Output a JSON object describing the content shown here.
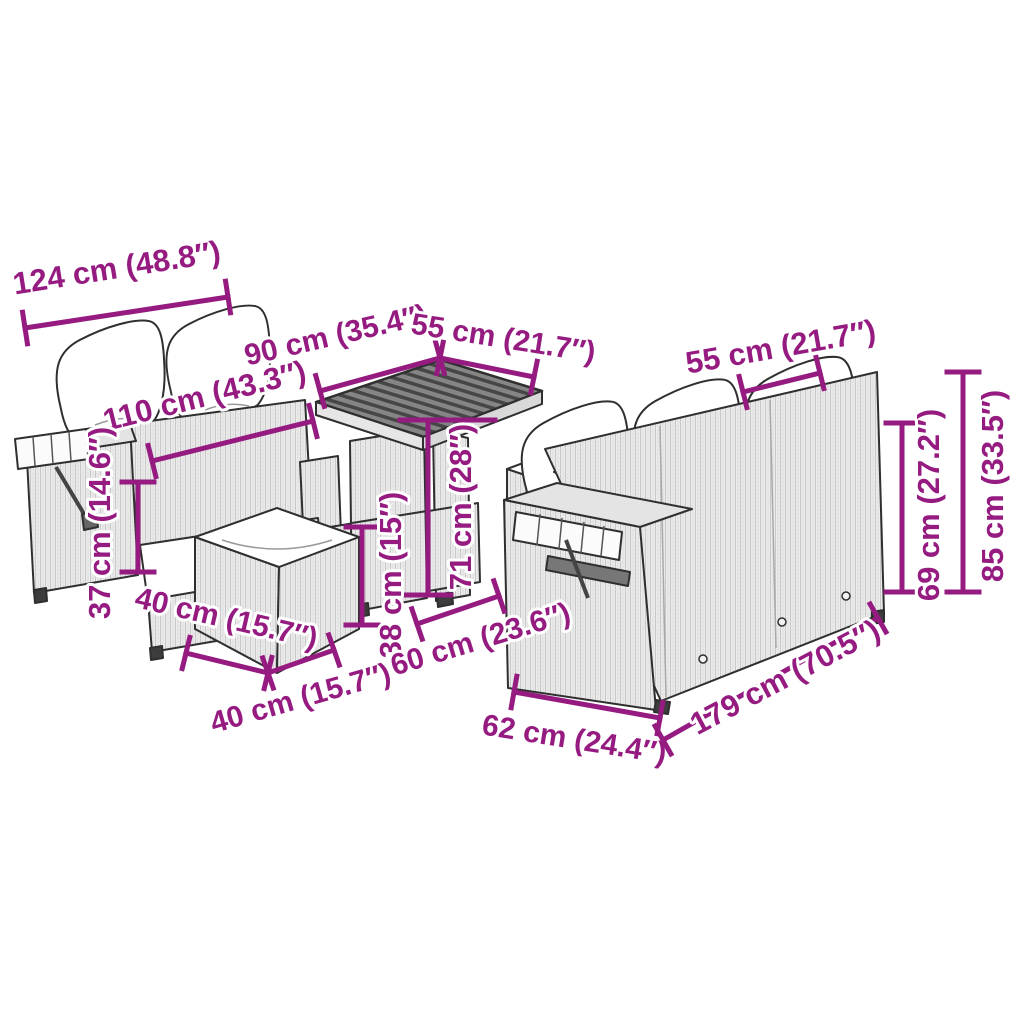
{
  "page": {
    "width": 1024,
    "height": 1024,
    "background": "#ffffff"
  },
  "diagram": {
    "description": "Poly rattan garden furniture set dimension diagram",
    "accent_color": "#951b81",
    "outline_color": "#2f2f2f",
    "pieces": [
      {
        "name": "two-seater-sofa-with-folding-tray"
      },
      {
        "name": "pedestal-table"
      },
      {
        "name": "footstool-front"
      },
      {
        "name": "footstool-middle"
      },
      {
        "name": "three-seater-sofa-with-folding-tray"
      }
    ],
    "dimensions": [
      {
        "name": "sofa2-width",
        "label": "124 cm (48.8″)",
        "line": [
          25,
          328,
          228,
          297
        ],
        "text": [
          117,
          270,
          -9,
          31
        ]
      },
      {
        "name": "sofa2-seat-width",
        "label": "110 cm (43.3″)",
        "line": [
          152,
          461,
          313,
          421
        ],
        "text": [
          205,
          398,
          -14,
          31
        ]
      },
      {
        "name": "table-length",
        "label": "90 cm (35.4″)",
        "line": [
          320,
          391,
          440,
          358
        ],
        "text": [
          336,
          337,
          -13,
          30
        ]
      },
      {
        "name": "table-width",
        "label": "55 cm (21.7″)",
        "line": [
          440,
          358,
          534,
          377
        ],
        "text": [
          503,
          340,
          9,
          30
        ]
      },
      {
        "name": "sofa3-cushion-width",
        "label": "55 cm (21.7″)",
        "line": [
          743,
          392,
          820,
          373
        ],
        "text": [
          781,
          349,
          -10,
          31
        ]
      },
      {
        "name": "table-height",
        "label": "71 cm (28″)",
        "line": [
          428,
          420,
          428,
          595
        ],
        "ticks": [
          [
            400,
            420,
            495,
            420
          ],
          [
            405,
            595,
            451,
            595
          ]
        ],
        "text": [
          463,
          507,
          -90,
          31
        ]
      },
      {
        "name": "table-shelf-height",
        "label": "38 cm (15″)",
        "line": [
          362,
          527,
          362,
          625
        ],
        "text": [
          393,
          575,
          -90,
          31
        ]
      },
      {
        "name": "sofa2-seat-height",
        "label": "37 cm (14.6″)",
        "line": [
          138,
          482,
          138,
          572
        ],
        "text": [
          102,
          523,
          -90,
          31
        ]
      },
      {
        "name": "stool-width",
        "label": "40 cm (15.7″)",
        "line": [
          186,
          653,
          268,
          673
        ],
        "text": [
          226,
          620,
          13,
          30
        ]
      },
      {
        "name": "stool-depth",
        "label": "40 cm (15.7″)",
        "line": [
          268,
          673,
          334,
          650
        ],
        "text": [
          301,
          700,
          -16,
          30
        ]
      },
      {
        "name": "sofa3-seat-depth",
        "label": "60 cm (23.6″)",
        "line": [
          417,
          624,
          499,
          596
        ],
        "text": [
          481,
          641,
          -17,
          30
        ]
      },
      {
        "name": "sofa3-depth",
        "label": "62 cm (24.4″)",
        "line": [
          514,
          692,
          660,
          718
        ],
        "text": [
          574,
          741,
          9,
          30
        ]
      },
      {
        "name": "sofa3-width",
        "label": "179 cm (70.5″)",
        "line": [
          663,
          740,
          878,
          618
        ],
        "text": [
          786,
          679,
          -28,
          31
        ]
      },
      {
        "name": "sofa3-back-height",
        "label": "69 cm (27.2″)",
        "line": [
          902,
          423,
          902,
          592
        ],
        "text": [
          931,
          505,
          -90,
          31
        ]
      },
      {
        "name": "sofa3-total-height",
        "label": "85 cm (33.5″)",
        "line": [
          963,
          372,
          963,
          592
        ],
        "text": [
          995,
          486,
          -90,
          31
        ]
      }
    ]
  }
}
